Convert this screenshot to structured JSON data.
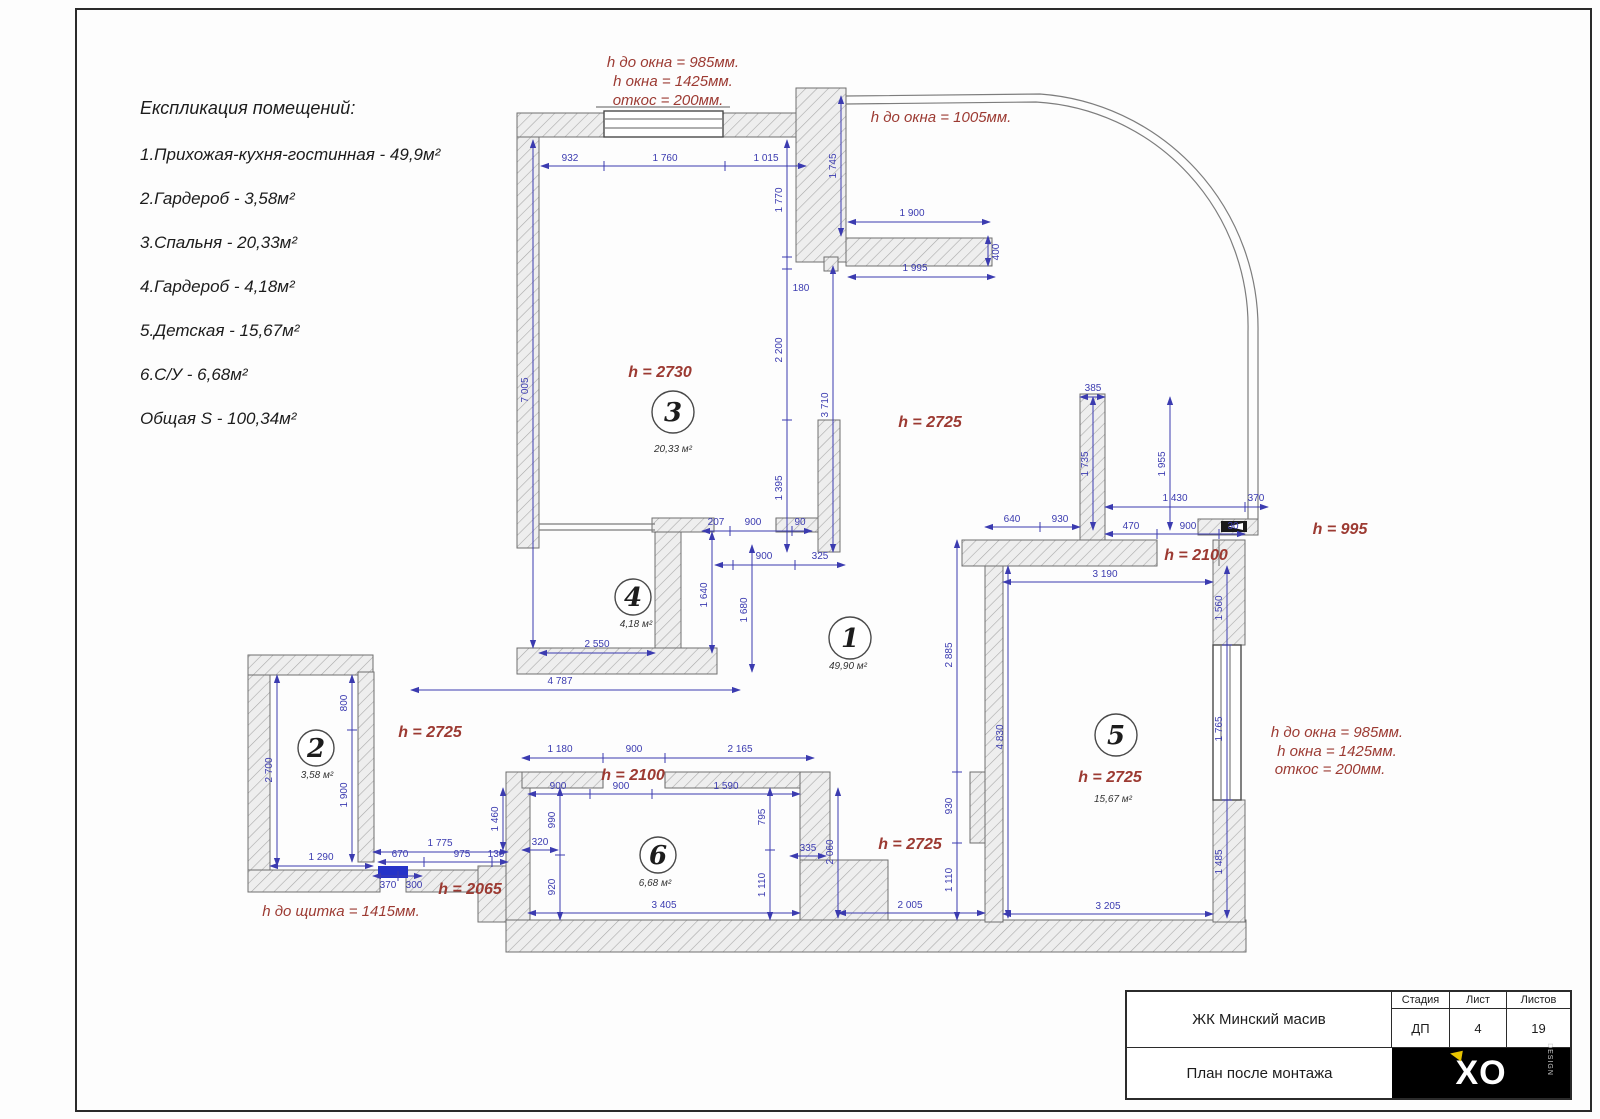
{
  "colors": {
    "dim": "#3b3bb0",
    "height": "#9c3a32",
    "panel": "#2533c8",
    "logo_bg": "#000000",
    "logo_accent": "#e8c400"
  },
  "legend": {
    "title": "Експликация помещений:",
    "items": [
      "1.Прихожая-кухня-гостинная - 49,9м²",
      "2.Гардероб - 3,58м²",
      "3.Спальня - 20,33м²",
      "4.Гардероб - 4,18м²",
      "5.Детская - 15,67м²",
      "6.С/У - 6,68м²",
      "Общая S - 100,34м²"
    ]
  },
  "annotations": {
    "top_window": [
      "h до окна = 985мм.",
      "h окна = 1425мм.",
      "откос = 200мм."
    ],
    "bay_window": "h до окна = 1005мм.",
    "right_window": [
      "h до окна = 985мм.",
      "h окна = 1425мм.",
      "откос = 200мм."
    ],
    "panel": "h до щитка = 1415мм."
  },
  "heights": {
    "r3": "h = 2730",
    "corr_top": "h = 2725",
    "r2": "h = 2725",
    "corr": "h = 2725",
    "r5": "h = 2725",
    "d6": "h = 2100",
    "d5": "h = 2100",
    "niche": "h = 995",
    "d2": "h = 2065"
  },
  "rooms": {
    "r1": {
      "num": "1",
      "area": "49,90 м²"
    },
    "r2": {
      "num": "2",
      "area": "3,58 м²"
    },
    "r3": {
      "num": "3",
      "area": "20,33 м²"
    },
    "r4": {
      "num": "4",
      "area": "4,18 м²"
    },
    "r5": {
      "num": "5",
      "area": "15,67 м²"
    },
    "r6": {
      "num": "6",
      "area": "6,68 м²"
    }
  },
  "dims": {
    "r3_top": [
      "932",
      "1 760",
      "1 015"
    ],
    "bay": [
      "1 745",
      "1 900",
      "400",
      "1 995"
    ],
    "r3_left": "7 005",
    "r3_right": [
      "1 770",
      "180",
      "2 200",
      "1 395"
    ],
    "corr3": "3 710",
    "r3_door": [
      "207",
      "900",
      "90",
      "900",
      "325"
    ],
    "r4": [
      "1 640",
      "1 680",
      "2 550",
      "4 787"
    ],
    "r1": [
      "2 885",
      "930",
      "1 110"
    ],
    "r2": [
      "2 700",
      "800",
      "1 900",
      "1 290",
      "1 460"
    ],
    "r2_door": [
      "1 775",
      "670",
      "975",
      "130",
      "370",
      "300"
    ],
    "r6_top": [
      "1 180",
      "900",
      "2 165"
    ],
    "r6_in": [
      "900",
      "900",
      "1 590"
    ],
    "r6_left": [
      "990",
      "920",
      "320"
    ],
    "r6_right": [
      "795",
      "335",
      "1 110",
      "2 060"
    ],
    "r6_bot": "3 405",
    "corr_bot": "2 005",
    "r5_bot": "3 205",
    "r5": [
      "3 190",
      "4 830",
      "1 560",
      "1 765",
      "1 485"
    ],
    "r5_col": [
      "385",
      "1 735",
      "1 955"
    ],
    "r5_top": [
      "1 430",
      "370",
      "470",
      "900",
      "30",
      "640",
      "930"
    ]
  },
  "titleblock": {
    "project": "ЖК Минский масив",
    "drawing": "План после монтажа",
    "stage_label": "Стадия",
    "sheet_label": "Лист",
    "sheets_label": "Листов",
    "stage": "ДП",
    "sheet": "4",
    "sheets": "19",
    "logo": "XO",
    "logo_sub": "DESIGN"
  }
}
